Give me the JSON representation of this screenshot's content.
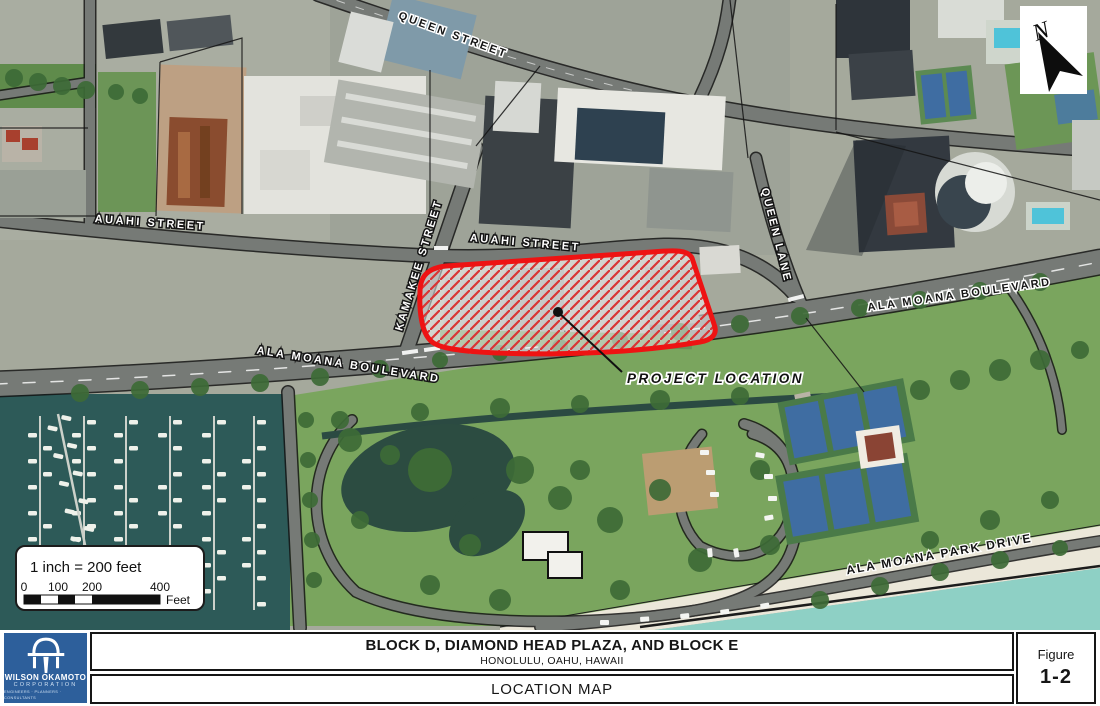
{
  "figure": {
    "title": "BLOCK D, DIAMOND HEAD PLAZA, AND BLOCK E",
    "subtitle": "HONOLULU, OAHU, HAWAII",
    "map_type": "LOCATION MAP",
    "figure_label": "Figure",
    "figure_number": "1-2"
  },
  "logo": {
    "line1": "WILSON OKAMOTO",
    "line2": "CORPORATION",
    "line3": "ENGINEERS · PLANNERS · CONSULTANTS"
  },
  "north_arrow": {
    "label": "N"
  },
  "scale_bar": {
    "caption": "1 inch = 200 feet",
    "ticks": [
      "0",
      "100",
      "200",
      "400"
    ],
    "unit": "Feet"
  },
  "map": {
    "labels": {
      "queen_street": "QUEEN STREET",
      "auahi_street_west": "AUAHI STREET",
      "auahi_street_east": "AUAHI STREET",
      "kamakee_street": "KAMAKEE STREET",
      "queen_lane": "QUEEN LANE",
      "ala_moana_blvd_west": "ALA MOANA BOULEVARD",
      "ala_moana_blvd_east": "ALA MOANA BOULEVARD",
      "ala_moana_park_drive": "ALA MOANA PARK DRIVE",
      "project_location": "PROJECT LOCATION"
    },
    "colors": {
      "project_outline": "#ee1313",
      "project_hatch": "#d93434",
      "logo_blue": "#2d5f9b",
      "marina_water": "#2d5a58",
      "ocean": "#8ed0c5",
      "park_green": "#7aa55e"
    }
  }
}
